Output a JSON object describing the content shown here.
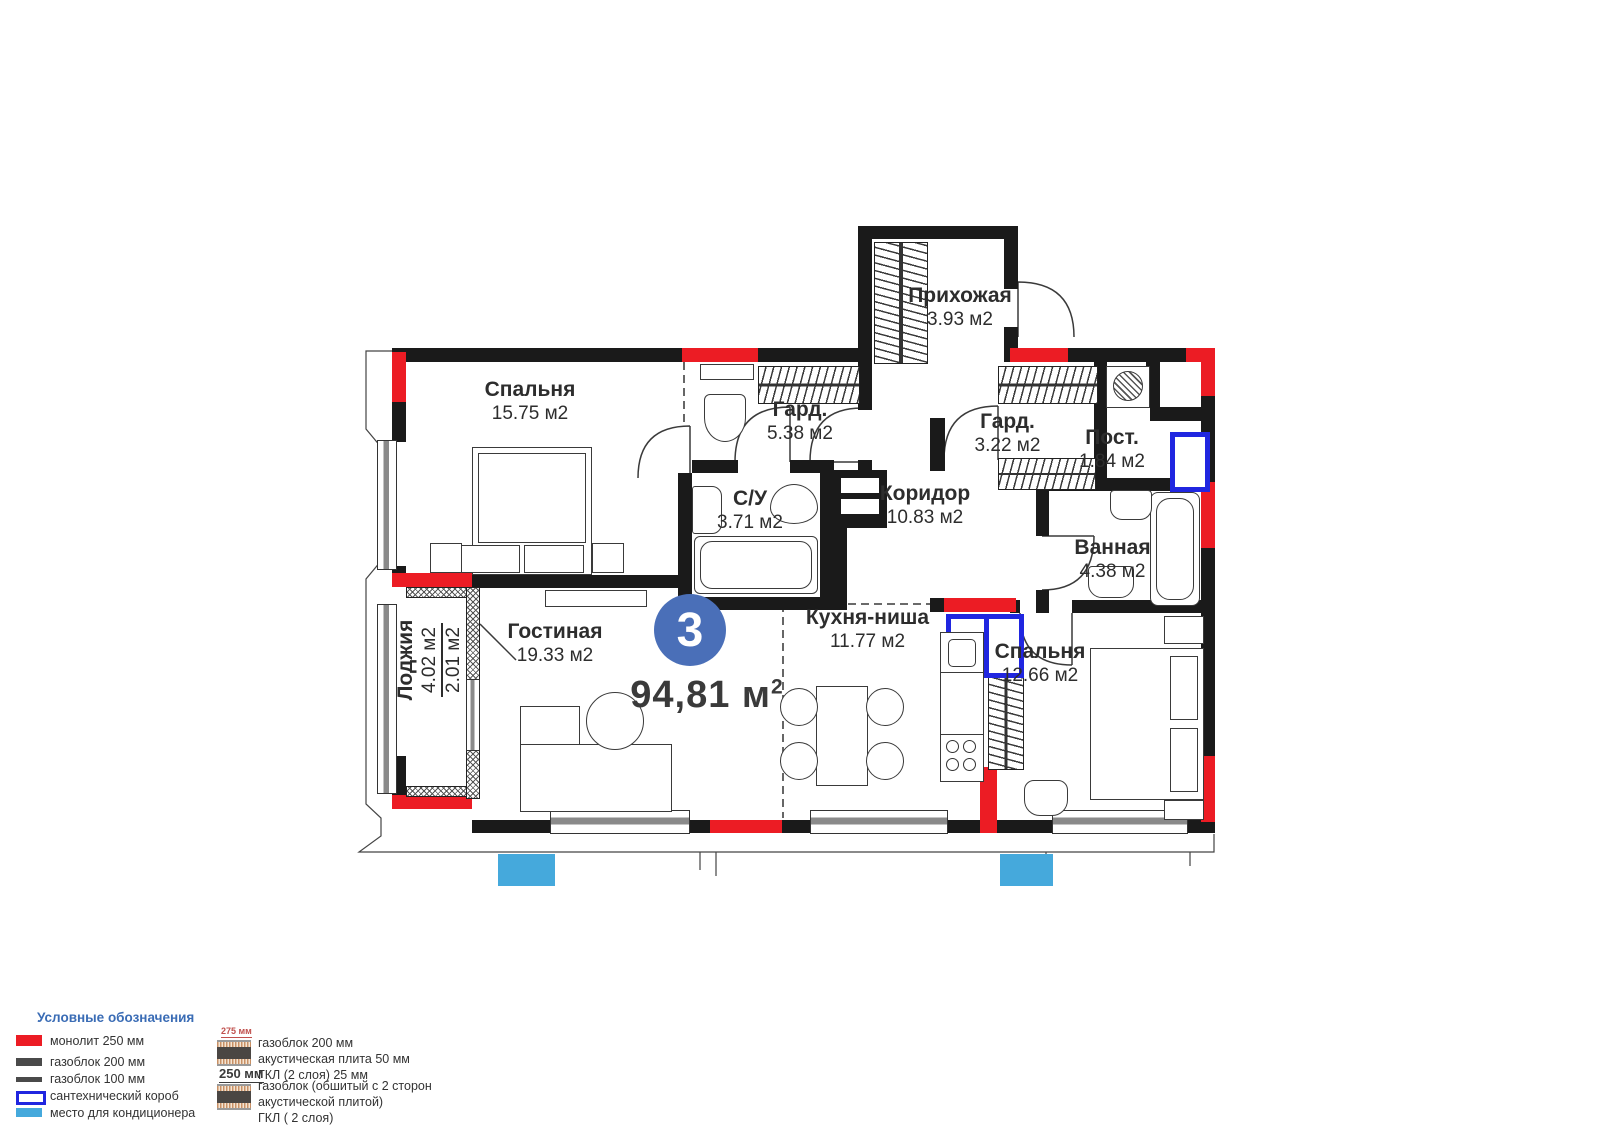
{
  "plan": {
    "badge": "3",
    "total_area": {
      "value": "94,81 м",
      "sup": "2"
    },
    "rooms": [
      {
        "id": "bedroom1",
        "name": "Спальня",
        "area": "15.75 м2"
      },
      {
        "id": "wardrobe1",
        "name": "Гард.",
        "area": "5.38 м2"
      },
      {
        "id": "hallway",
        "name": "Прихожая",
        "area": "3.93 м2"
      },
      {
        "id": "wardrobe2",
        "name": "Гард.",
        "area": "3.22 м2"
      },
      {
        "id": "laundry",
        "name": "Пост.",
        "area": "1.84 м2"
      },
      {
        "id": "wc",
        "name": "С/У",
        "area": "3.71 м2"
      },
      {
        "id": "corridor",
        "name": "Коридор",
        "area": "10.83 м2"
      },
      {
        "id": "bathroom",
        "name": "Ванная",
        "area": "4.38 м2"
      },
      {
        "id": "kitchen",
        "name": "Кухня-ниша",
        "area": "11.77 м2"
      },
      {
        "id": "bedroom2",
        "name": "Спальня",
        "area": "12.66 м2"
      },
      {
        "id": "living",
        "name": "Гостиная",
        "area": "19.33 м2"
      },
      {
        "id": "loggia",
        "name": "Лоджия",
        "area1": "4.02 м2",
        "area2": "2.01 м2"
      }
    ],
    "colors": {
      "monolith_red": "#ec1c24",
      "wall_black": "#1a1a1a",
      "plumbing_blue": "#2026e0",
      "ac_blue": "#45a9dc",
      "badge_blue": "#4a6fb8",
      "legend_title_blue": "#3a6cb5"
    }
  },
  "legend": {
    "title": "Условные обозначения",
    "items": [
      {
        "label": "монолит 250 мм",
        "type": "monolith"
      },
      {
        "label": "газоблок 200 мм",
        "type": "gasblock-200"
      },
      {
        "label": "газоблок 100 мм",
        "type": "gasblock-100"
      },
      {
        "label": "сантехнический короб",
        "type": "plumbing-box"
      },
      {
        "label": "место для кондиционера",
        "type": "ac-place"
      }
    ],
    "sections": [
      {
        "thickness": "275 мм",
        "lines": [
          "газоблок 200 мм",
          "акустическая плита 50 мм",
          "ГКЛ (2 слоя) 25 мм"
        ]
      },
      {
        "thickness": "250 мм",
        "lines": [
          "газоблок (обшитый с 2 сторон",
          "акустической плитой)",
          "ГКЛ ( 2 слоя)"
        ]
      }
    ]
  }
}
